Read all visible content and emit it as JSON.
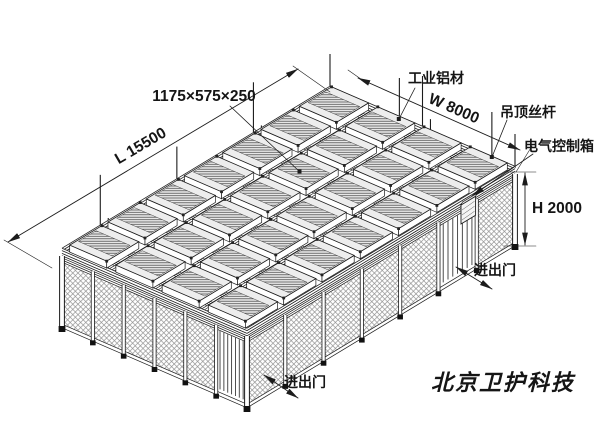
{
  "drawing": {
    "labels": {
      "unit_size": "1175×575×250",
      "aluminum_profile": "工业铝材",
      "ceiling_rod": "吊顶丝杆",
      "electric_control_box": "电气控制箱",
      "door_right": "进出门",
      "door_bottom": "进出门"
    },
    "dimensions": {
      "length": "L 15500",
      "width": "W 8000",
      "height": "H 2000"
    },
    "watermark": "北京卫护科技"
  },
  "structure": {
    "iso": {
      "back": [
        330,
        90
      ],
      "u": [
        185,
        80
      ],
      "v": [
        -268,
        162
      ]
    },
    "wall": {
      "top_offset": 8,
      "bottom_offset": 74
    },
    "grid": {
      "bays_length": 7,
      "bays_width": 4,
      "unit_rows": 7,
      "units_per_row": 4
    },
    "left_wall": {
      "bays": 6,
      "door_bay": 5
    },
    "right_wall": {
      "bays": 7,
      "door_bay": 5
    },
    "rods": {
      "base_height": 34,
      "step": 9
    }
  },
  "colors": {
    "line": "#1c1c1c",
    "mesh": "#8a8a8a",
    "unit_top": "#ededed",
    "watermark": "#d8d8d8",
    "background": "#ffffff"
  }
}
